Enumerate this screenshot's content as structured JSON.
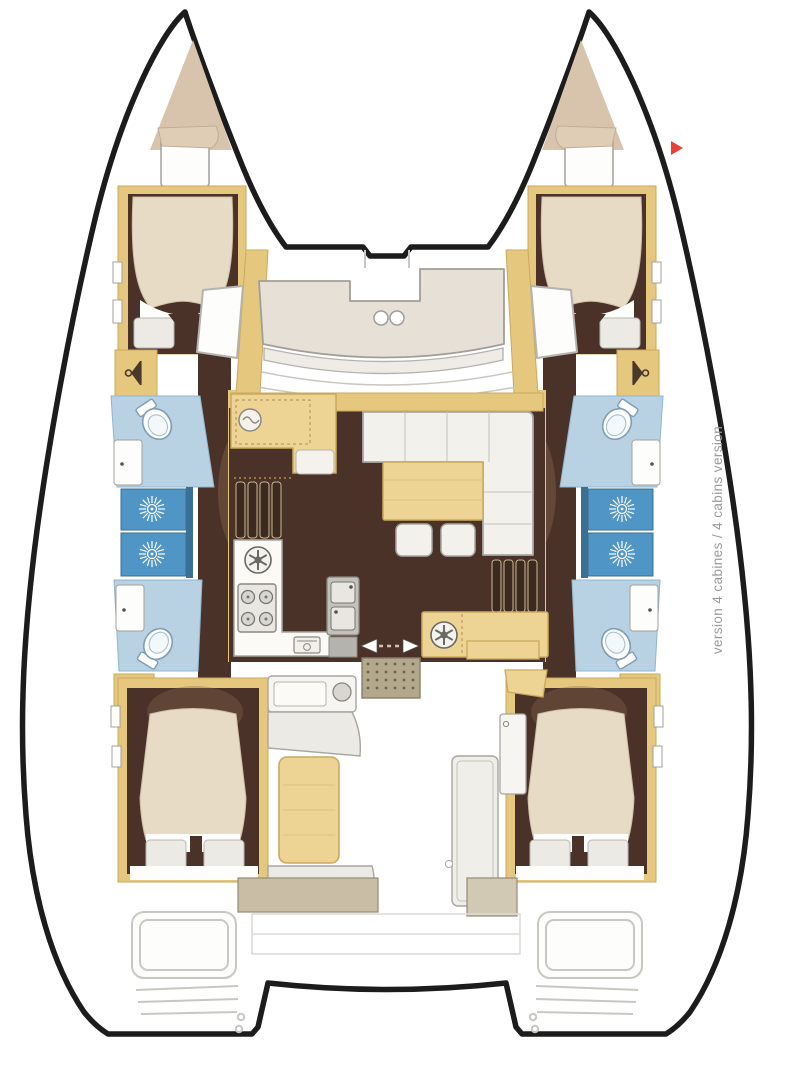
{
  "caption": {
    "text": "version 4 cabines / 4 cabins version"
  },
  "marker": {
    "shape": "right-pointing-triangle"
  },
  "palette": {
    "outline": "#1c1c1c",
    "wood": "#e5c77e",
    "woodLight": "#eed494",
    "woodEdge": "#c9a95e",
    "floorDark": "#4a3228",
    "floorFan": "#8a6a50",
    "forepeak": "#d8c4ac",
    "bedCream": "#e7dbc6",
    "pillow": "#eceae4",
    "offWhite": "#f1efe9",
    "benchGray": "#e6e0d6",
    "grayLine": "#a3a19b",
    "lightLine": "#c9c7c1",
    "bathLight": "#b8d1e3",
    "bathEdge": "#8fb6cf",
    "showerBlue": "#4f95c5",
    "showerDark": "#3a7093",
    "fixture": "#7d9db5",
    "steel": "#c3c1bb",
    "grate": "#b3a78c",
    "grateDot": "#6b6250",
    "tanMuted": "#c9bda6",
    "darkIcon": "#4a382a",
    "captionGray": "#9a9a9a",
    "red": "#e8403a"
  }
}
